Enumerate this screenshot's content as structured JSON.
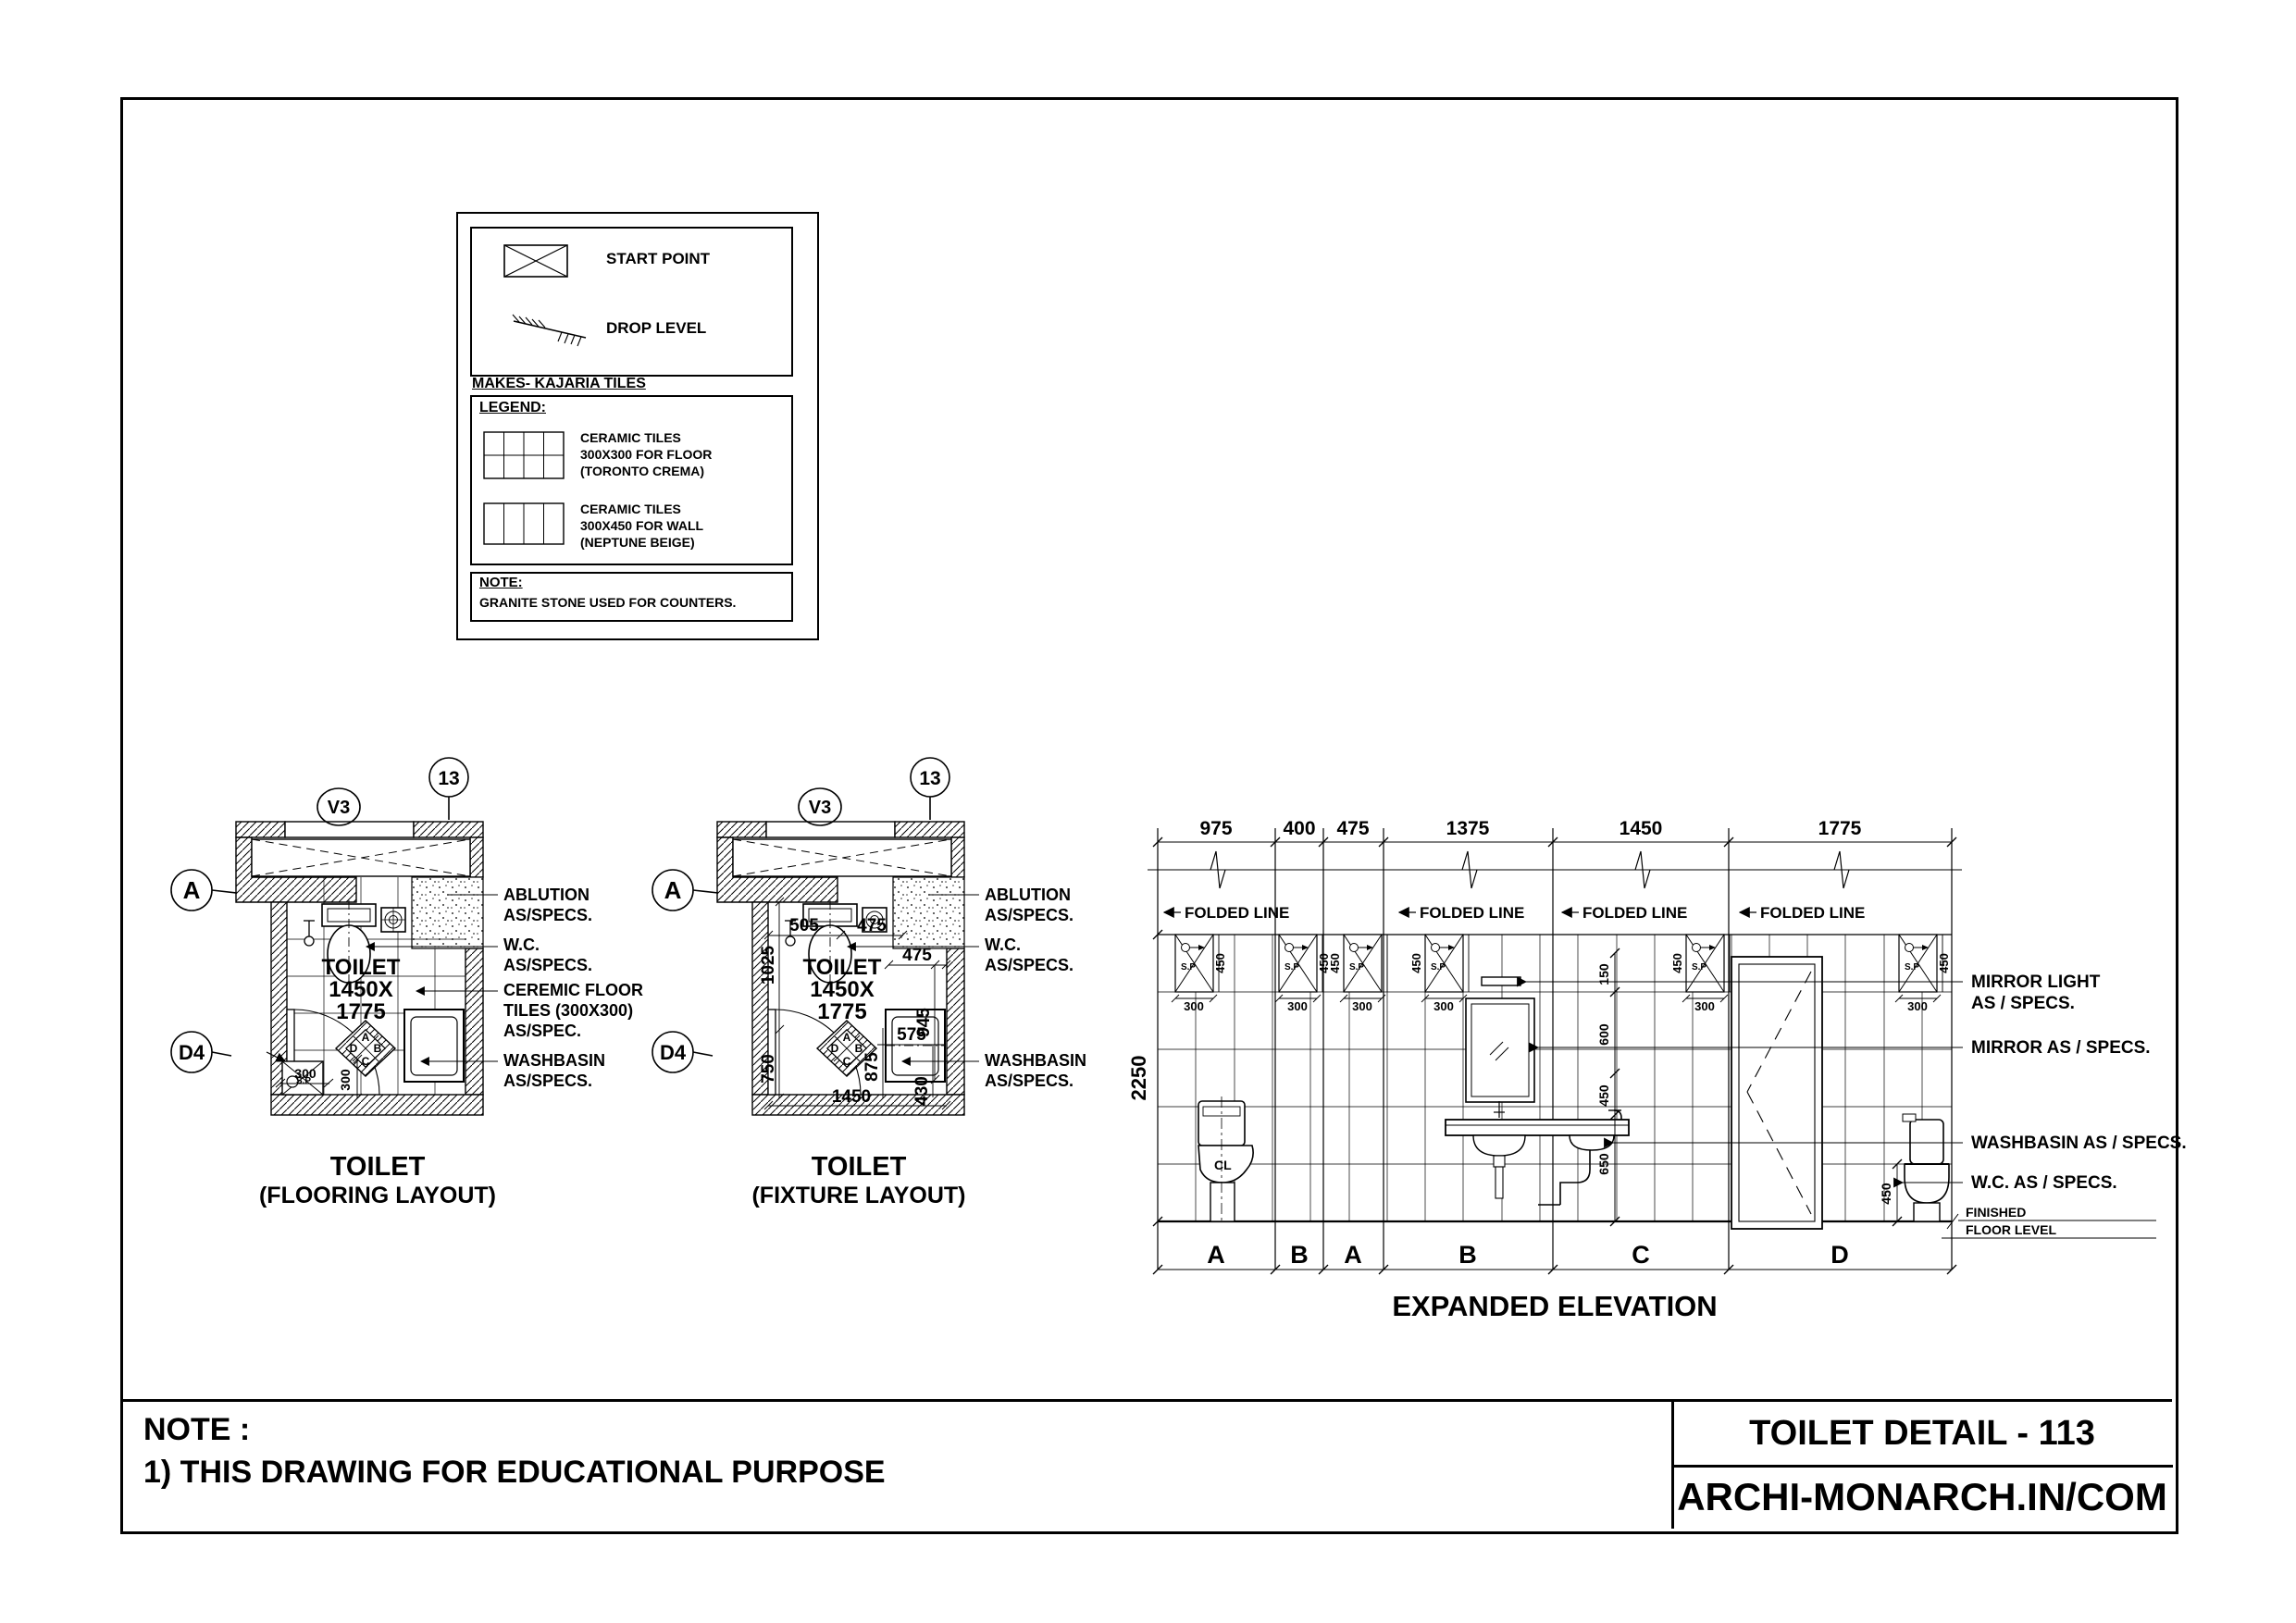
{
  "sheet": {
    "note_label": "NOTE :",
    "note_line": "1) THIS DRAWING FOR EDUCATIONAL PURPOSE",
    "title": "TOILET DETAIL - 113",
    "website": "ARCHI-MONARCH.IN/COM"
  },
  "legend": {
    "start_point": "START POINT",
    "drop_level": "DROP LEVEL",
    "makes": "MAKES- KAJARIA TILES",
    "heading": "LEGEND:",
    "floor_tile_l1": "CERAMIC TILES",
    "floor_tile_l2": "300X300 FOR FLOOR",
    "floor_tile_l3": "(TORONTO CREMA)",
    "wall_tile_l1": "CERAMIC TILES",
    "wall_tile_l2": "300X450 FOR WALL",
    "wall_tile_l3": "(NEPTUNE BEIGE)",
    "note_label": "NOTE:",
    "note_text": "GRANITE STONE USED FOR COUNTERS."
  },
  "markers": {
    "v3": "V3",
    "s13": "13",
    "a": "A",
    "d4": "D4",
    "sp": "S.P",
    "cl": "CL"
  },
  "room": {
    "l1": "TOILET",
    "l2": "1450X",
    "l3": "1775"
  },
  "compass": {
    "top": "A",
    "right": "B",
    "bottom": "C",
    "left": "D"
  },
  "plan1": {
    "title1": "TOILET",
    "title2": "(FLOORING LAYOUT)",
    "lbl_ablution1": "ABLUTION",
    "lbl_ablution2": "AS/SPECS.",
    "lbl_wc1": "W.C.",
    "lbl_wc2": "AS/SPECS.",
    "lbl_tiles1": "CEREMIC FLOOR",
    "lbl_tiles2": "TILES (300X300)",
    "lbl_tiles3": "AS/SPEC.",
    "lbl_wb1": "WASHBASIN",
    "lbl_wb2": "AS/SPECS.",
    "dim_300h": "300",
    "dim_300v": "300"
  },
  "plan2": {
    "title1": "TOILET",
    "title2": "(FIXTURE LAYOUT)",
    "lbl_ablution1": "ABLUTION",
    "lbl_ablution2": "AS/SPECS.",
    "lbl_wc1": "W.C.",
    "lbl_wc2": "AS/SPECS.",
    "lbl_wb1": "WASHBASIN",
    "lbl_wb2": "AS/SPECS.",
    "dims": {
      "top_left": "505",
      "top_right": "475",
      "left_upper": "1025",
      "niche": "475",
      "right_v1": "945",
      "shelf": "575",
      "right_v2": "875",
      "left_lower": "750",
      "right_v3": "430",
      "bottom": "1450"
    }
  },
  "elevation": {
    "title": "EXPANDED ELEVATION",
    "top_dims": [
      "975",
      "400",
      "475",
      "1375",
      "1450",
      "1775"
    ],
    "folded_line": "FOLDED LINE",
    "height_dim": "2250",
    "sp_h": "450",
    "sp_w": "300",
    "right_dims": [
      "150",
      "600",
      "450",
      "650"
    ],
    "sections": [
      "A",
      "B",
      "A",
      "B",
      "C",
      "D"
    ],
    "wc_height": "450",
    "lbl_mirror_light1": "MIRROR LIGHT",
    "lbl_mirror_light2": "AS / SPECS.",
    "lbl_mirror": "MIRROR AS / SPECS.",
    "lbl_washbasin": "WASHBASIN AS / SPECS.",
    "lbl_wc": "W.C. AS / SPECS.",
    "ffl1": "FINISHED",
    "ffl2": "FLOOR LEVEL"
  }
}
